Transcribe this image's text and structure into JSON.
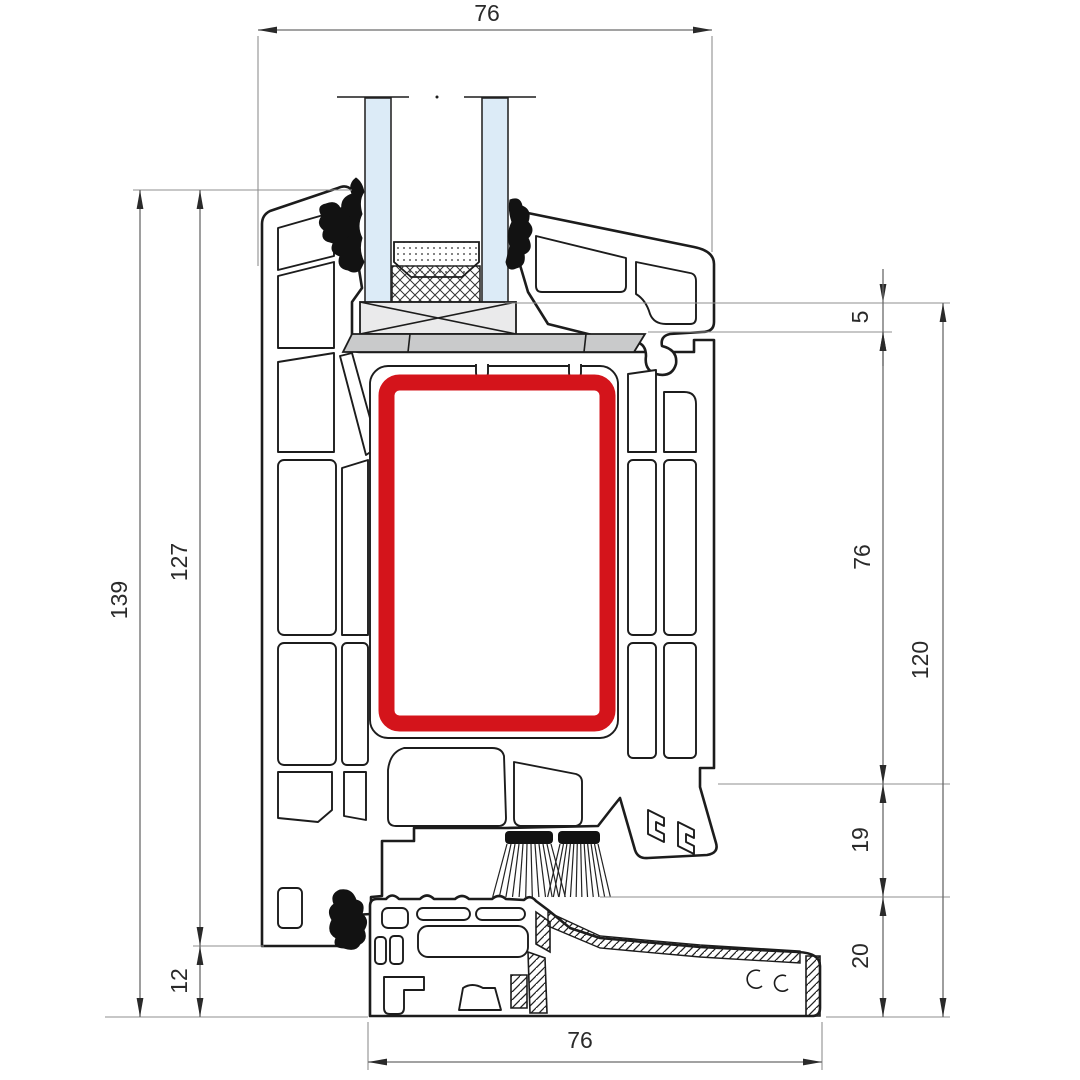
{
  "drawing": {
    "kind": "window-profile-cross-section",
    "description": "PVC window frame threshold section with steel reinforcement chamber highlighted"
  },
  "colors": {
    "highlight_red": "#d4141b",
    "glass_blue": "#dcebf7",
    "packer_gray": "#c9cacb",
    "block_gray": "#eaeaeb",
    "line_black": "#1c1c1c",
    "dim_gray": "#6a6a6a"
  },
  "dimensions": [
    {
      "id": "top-width",
      "value": "76",
      "line": {
        "x1": 258,
        "y1": 30,
        "x2": 712,
        "y2": 30
      },
      "arrows": "in",
      "label": {
        "x": 487,
        "y": 21,
        "rot": 0
      },
      "ext": [
        [
          258,
          36,
          258,
          266
        ],
        [
          712,
          36,
          712,
          252
        ]
      ]
    },
    {
      "id": "left-total-height",
      "value": "139",
      "line": {
        "x1": 140,
        "y1": 190,
        "x2": 140,
        "y2": 1017
      },
      "arrows": "in",
      "label": {
        "x": 127,
        "y": 600,
        "rot": -90
      },
      "ext": [
        [
          133,
          190,
          352,
          190
        ],
        [
          105,
          1017,
          368,
          1017
        ]
      ]
    },
    {
      "id": "left-frame-height",
      "value": "127",
      "line": {
        "x1": 200,
        "y1": 190,
        "x2": 200,
        "y2": 946
      },
      "arrows": "in",
      "label": {
        "x": 187,
        "y": 562,
        "rot": -90
      },
      "ext": [
        [
          193,
          946,
          264,
          946
        ]
      ]
    },
    {
      "id": "left-bottom-offset",
      "value": "12",
      "line": {
        "x1": 200,
        "y1": 946,
        "x2": 200,
        "y2": 1017
      },
      "arrows": "in",
      "label": {
        "x": 187,
        "y": 981,
        "rot": -90
      },
      "ext": []
    },
    {
      "id": "right-rebate-step",
      "value": "5",
      "line": {
        "x1": 883,
        "y1": 303,
        "x2": 883,
        "y2": 332
      },
      "arrows": "out",
      "label": {
        "x": 868,
        "y": 317,
        "rot": -90
      },
      "ext": [
        [
          505,
          303,
          950,
          303
        ],
        [
          648,
          332,
          892,
          332
        ]
      ]
    },
    {
      "id": "right-frame-height",
      "value": "76",
      "line": {
        "x1": 883,
        "y1": 332,
        "x2": 883,
        "y2": 784
      },
      "arrows": "in",
      "label": {
        "x": 870,
        "y": 557,
        "rot": -90
      },
      "ext": [
        [
          718,
          784,
          950,
          784
        ]
      ]
    },
    {
      "id": "right-gap",
      "value": "19",
      "line": {
        "x1": 883,
        "y1": 784,
        "x2": 883,
        "y2": 897
      },
      "arrows": "in",
      "label": {
        "x": 868,
        "y": 840,
        "rot": -90
      },
      "ext": [
        [
          600,
          897,
          950,
          897
        ]
      ]
    },
    {
      "id": "right-sill-height",
      "value": "20",
      "line": {
        "x1": 883,
        "y1": 897,
        "x2": 883,
        "y2": 1017
      },
      "arrows": "in",
      "label": {
        "x": 868,
        "y": 956,
        "rot": -90
      },
      "ext": [
        [
          826,
          1017,
          950,
          1017
        ]
      ]
    },
    {
      "id": "right-total-height",
      "value": "120",
      "line": {
        "x1": 943,
        "y1": 303,
        "x2": 943,
        "y2": 1017
      },
      "arrows": "in",
      "label": {
        "x": 928,
        "y": 660,
        "rot": -90
      },
      "ext": []
    },
    {
      "id": "bottom-width",
      "value": "76",
      "line": {
        "x1": 368,
        "y1": 1062,
        "x2": 822,
        "y2": 1062
      },
      "arrows": "in",
      "label": {
        "x": 580,
        "y": 1048,
        "rot": 0
      },
      "ext": [
        [
          368,
          1022,
          368,
          1070
        ],
        [
          822,
          1022,
          822,
          1070
        ]
      ]
    }
  ]
}
